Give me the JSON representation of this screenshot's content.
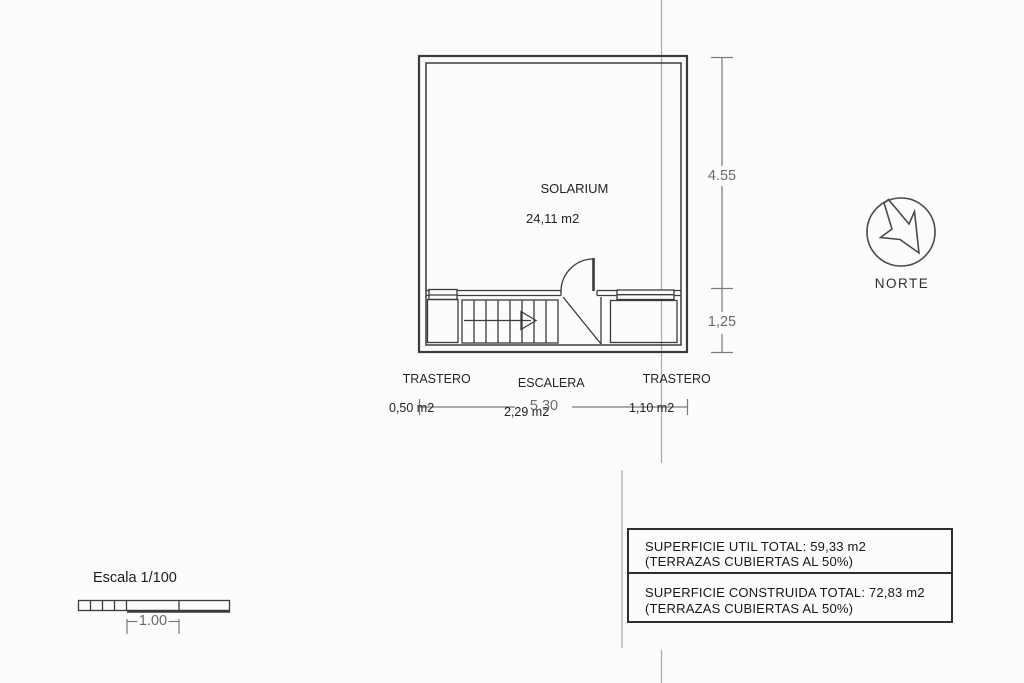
{
  "document": {
    "type": "floor-plan",
    "language": "es"
  },
  "plan": {
    "solarium": {
      "name": "SOLARIUM",
      "area": "24,11 m2"
    },
    "rooms": [
      {
        "name": "TRASTERO",
        "area": "0,50 m2"
      },
      {
        "name": "ESCALERA",
        "area": "2,29 m2"
      },
      {
        "name": "TRASTERO",
        "area": "1,10 m2"
      }
    ],
    "dimensions": {
      "upper_height": "4.55",
      "lower_height": "1,25",
      "total_width": "5.30"
    }
  },
  "north": {
    "label": "NORTE"
  },
  "scale": {
    "label": "Escala 1/100",
    "unit_dimension": "1.00"
  },
  "summary": {
    "rows": [
      {
        "title": "SUPERFICIE UTIL TOTAL: 59,33 m2",
        "note": "(TERRAZAS CUBIERTAS AL 50%)"
      },
      {
        "title": "SUPERFICIE CONSTRUIDA TOTAL: 72,83 m2",
        "note": "(TERRAZAS CUBIERTAS AL 50%)"
      }
    ]
  },
  "colors": {
    "paper": "#fcfcfb",
    "line": "#3b3b3b",
    "dimension": "#7a7a7a",
    "fold_line": "#a6a8ae"
  }
}
